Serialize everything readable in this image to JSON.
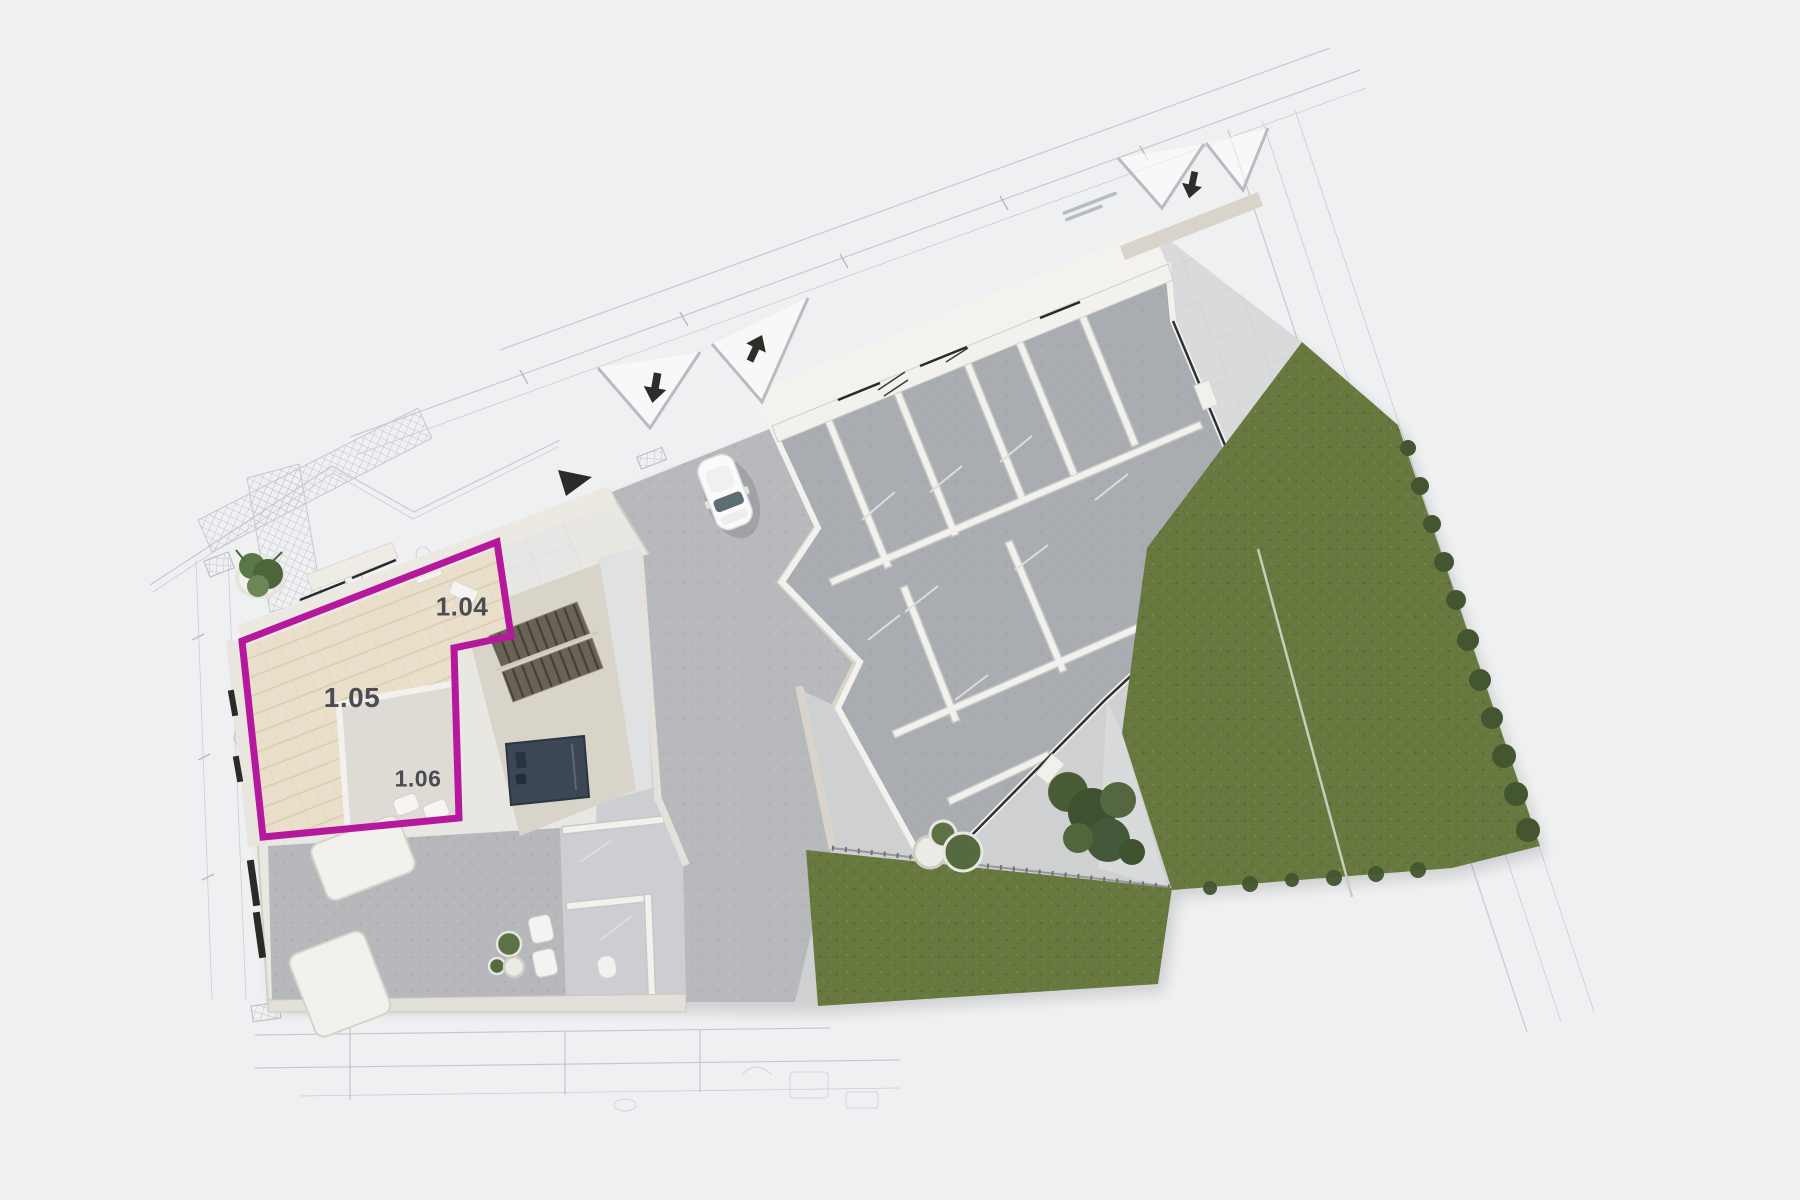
{
  "scene": {
    "kind": "3d-rendered site floor plan on blueprint background",
    "unit": {
      "outline_color": "#b5189c",
      "rooms": [
        {
          "label": "1.04"
        },
        {
          "label": "1.05"
        },
        {
          "label": "1.06"
        }
      ]
    }
  },
  "icons": {
    "gate_arrow": "solid dark arrow marking entrance direction",
    "north_marker": "solid dark triangle marker",
    "gate": "double-triangle opened gate symbol"
  },
  "colors": {
    "bg": "#eff0f2",
    "blueprint": "#c7c9cf",
    "slab": "#e9e7e2",
    "stone": "#d9d4c9",
    "wallWhite": "#f2f1ed",
    "wood": "#e9dfca",
    "woodLine": "#d9cdb0",
    "tileLight": "#dfe1e3",
    "tileMid": "#ccced2",
    "tileDark": "#b6b8bc",
    "roomGray": "#a9acb1",
    "asphalt": "#b7b9bc",
    "terrace": "#d9dadc",
    "grass": "#67793f",
    "hedge": "#43562f",
    "navy": "#3c4654",
    "magenta": "#b5189c",
    "ink": "#2c2b29",
    "label": "#4b4d52",
    "fence": "#96989b"
  }
}
